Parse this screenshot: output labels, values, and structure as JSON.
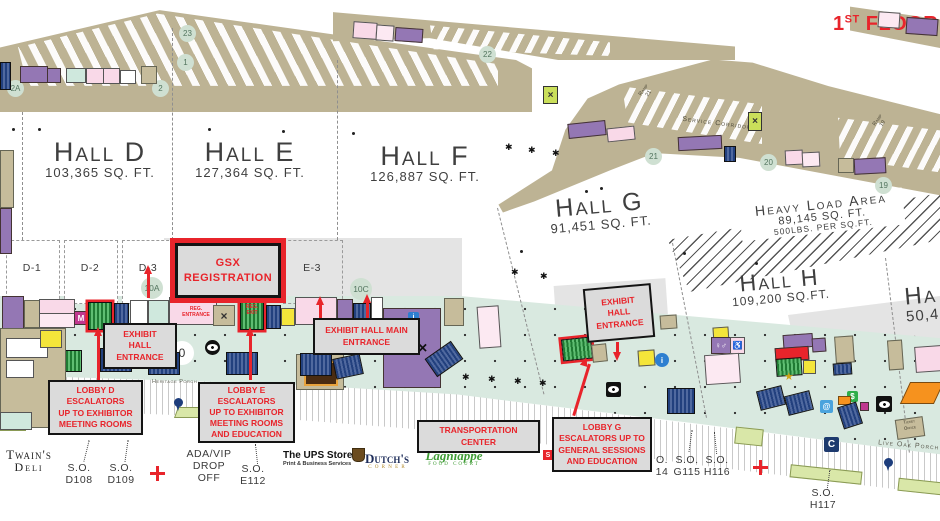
{
  "floor_label": {
    "num": "1",
    "sup": "ST",
    "rest": " FLOOR"
  },
  "halls": {
    "d": {
      "name": "Hall D",
      "sqft": "103,365 SQ. FT."
    },
    "e": {
      "name": "Hall E",
      "sqft": "127,364 SQ. FT."
    },
    "f": {
      "name": "Hall F",
      "sqft": "126,887 SQ. FT."
    },
    "g": {
      "name": "Hall G",
      "sqft": "91,451 SQ. FT."
    },
    "h": {
      "name": "Hall H",
      "sqft": "109,200 SQ.FT."
    },
    "partial": {
      "name": "Ha",
      "sqft": "50,4"
    }
  },
  "heavy_load": {
    "line1": "Heavy Load Area",
    "line2": "89,145 SQ. FT.",
    "line3": "500LBS. PER SQ.FT."
  },
  "rooms": {
    "d1": "D-1",
    "d2": "D-2",
    "d3": "D-3",
    "e3": "E-3"
  },
  "markers": {
    "m2a": "2A",
    "m2": "2",
    "m1": "1",
    "m23": "23",
    "m22": "22",
    "m21": "21",
    "m20": "20",
    "m19": "19",
    "m10a": "10A",
    "m10c": "10C",
    "m10b": "0"
  },
  "callouts": {
    "gsx": "GSX\nREGISTRATION",
    "exhibit_d": "EXHIBIT\nHALL\nENTRANCE",
    "exhibit_main": "EXHIBIT HALL MAIN\nENTRANCE",
    "exhibit_g": "EXHIBIT\nHALL\nENTRANCE",
    "lobby_d": "LOBBY D\nESCALATORS\nUP TO EXHIBITOR\nMEETING ROOMS",
    "lobby_e": "LOBBY E\nESCALATORS\nUP TO EXHIBITOR\nMEETING ROOMS\nAND EDUCATION",
    "transportation": "TRANSPORTATION\nCENTER",
    "lobby_g": "LOBBY G\nESCALATORS UP TO\nGENERAL SESSIONS\nAND EDUCATION"
  },
  "reg_signs": {
    "entrance": "REG.\nENTRANCE",
    "exit": "REG.\nEXIT"
  },
  "so_labels": {
    "d108": "S.O.\nD108",
    "d109": "S.O.\nD109",
    "e112": "S.O.\nE112",
    "g114": "O.\n14",
    "g115": "S.O.\nG115",
    "h116": "S.O.\nH116",
    "h117": "S.O.\nH117"
  },
  "dropoff": "ADA/VIP\nDROP OFF",
  "porches": {
    "heritage": "Heritage Porch",
    "live_oak": "Live Oak Porch"
  },
  "service": {
    "corridor": "Service Corridor",
    "ramp21": "Ramp\n21",
    "ramp19": "Ramp\n19",
    "ticket": "Ticket\nOffice"
  },
  "logos": {
    "twains_line1": "Twain's",
    "twains_line2": "Deli",
    "ups_line1": "The UPS Store",
    "ups_line2": "Print & Business Services",
    "dutchs_line1": "Dutch's",
    "dutchs_line2": "C O R N E R",
    "lagniappe_line1": "Lagniappe",
    "lagniappe_line2": "FOOD COURT"
  },
  "icon_glyphs": {
    "m": "M",
    "c": "C",
    "dollar": "$",
    "at": "@",
    "s": "S",
    "star": "★",
    "x": "×",
    "restroom": "♀♂",
    "access": "♿",
    "planter": "✱",
    "info": "i"
  },
  "colors": {
    "accent_red": "#e8242b",
    "lobby_mint": "#d9e9e0",
    "tan": "#bdb394",
    "callout_fill": "#dbdbdb",
    "marker_green": "#cfe0d2"
  }
}
